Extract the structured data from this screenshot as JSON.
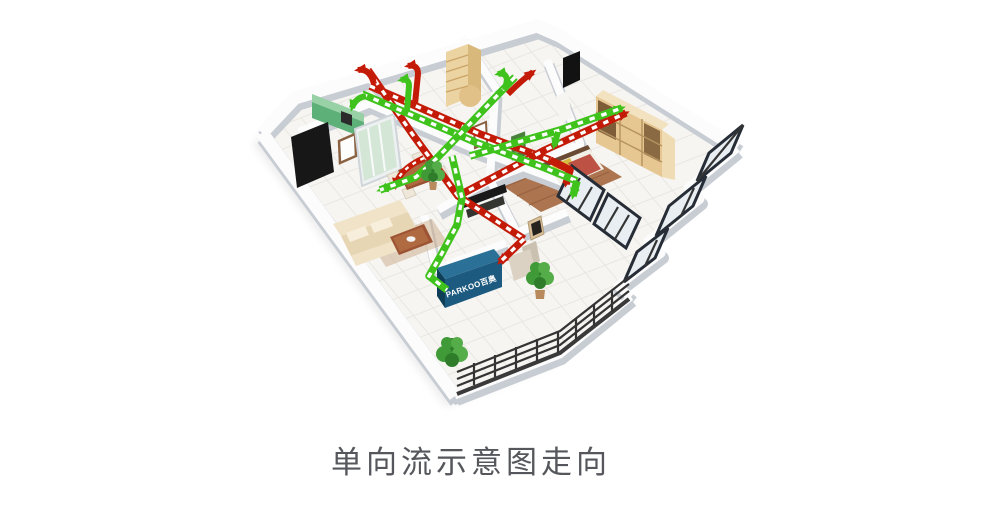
{
  "page": {
    "background": "#ffffff"
  },
  "caption": {
    "text": "单向流示意图走向",
    "color": "#55575c"
  },
  "scene": {
    "description": "isometric-apartment-one-way-flow-ventilation-cutaway",
    "unit": {
      "label": "PARKOO百奥",
      "top_color": "#2b7096",
      "front_color": "#1d5a7f",
      "label_color": "#ffffff"
    },
    "flows": {
      "supply": {
        "meaning": "fresh-air-supply-duct",
        "color": "#3fc31c",
        "dash": "#ffffff"
      },
      "exhaust": {
        "meaning": "exhaust-air-duct",
        "color": "#c41b08",
        "dash": "#ffffff"
      }
    },
    "palette": {
      "wall_top": "#fcfcfd",
      "wall_shadow": "#c8cdd4",
      "floor": "#f6f5f2",
      "tile_line": "#eae7e1",
      "slab_side": "#c6cbd1",
      "wood_floor": "#ad7450",
      "cabinet_green_top": "#98d1a6",
      "cabinet_green_front": "#5db077",
      "wardrobe_tan": "#e6c691",
      "window_frame": "#262d36",
      "sofa_beige": "#e7d6b4",
      "table_brown": "#9a5232"
    }
  }
}
